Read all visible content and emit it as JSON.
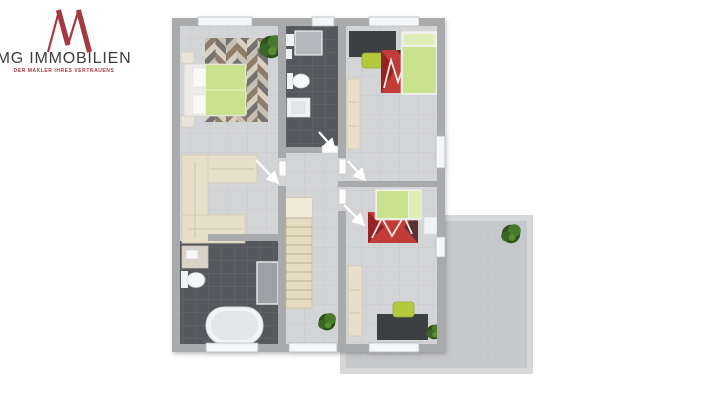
{
  "logo": {
    "monogram": "M",
    "company": "MG IMMOBILIEN",
    "tagline": "DER MAKLER IHRES VERTRAUENS",
    "monogram_color": "#a53942",
    "text_color": "#3c3c3e",
    "tagline_color": "#a53942"
  },
  "floorplan": {
    "colors": {
      "wall": "#a8aaac",
      "wall_light": "#d6d7d9",
      "floor": "#d3d4d6",
      "tile_dark": "#55585c",
      "terrace": "#c7c8ca",
      "window": "#f5f6f7",
      "bed_green": "#c9e28c",
      "bed_pillow": "#dfeeb7",
      "chair_green": "#b5c93e",
      "desk_dark": "#3c3f43",
      "wood_light": "#e7dfca",
      "stairs": "#e6dcc2",
      "rug_red": "#c23a38",
      "vanity": "#d9d4c7",
      "shower_gray": "#9da0a4",
      "white_fixture": "#f2f3f4",
      "arrow": "#ffffff"
    }
  }
}
